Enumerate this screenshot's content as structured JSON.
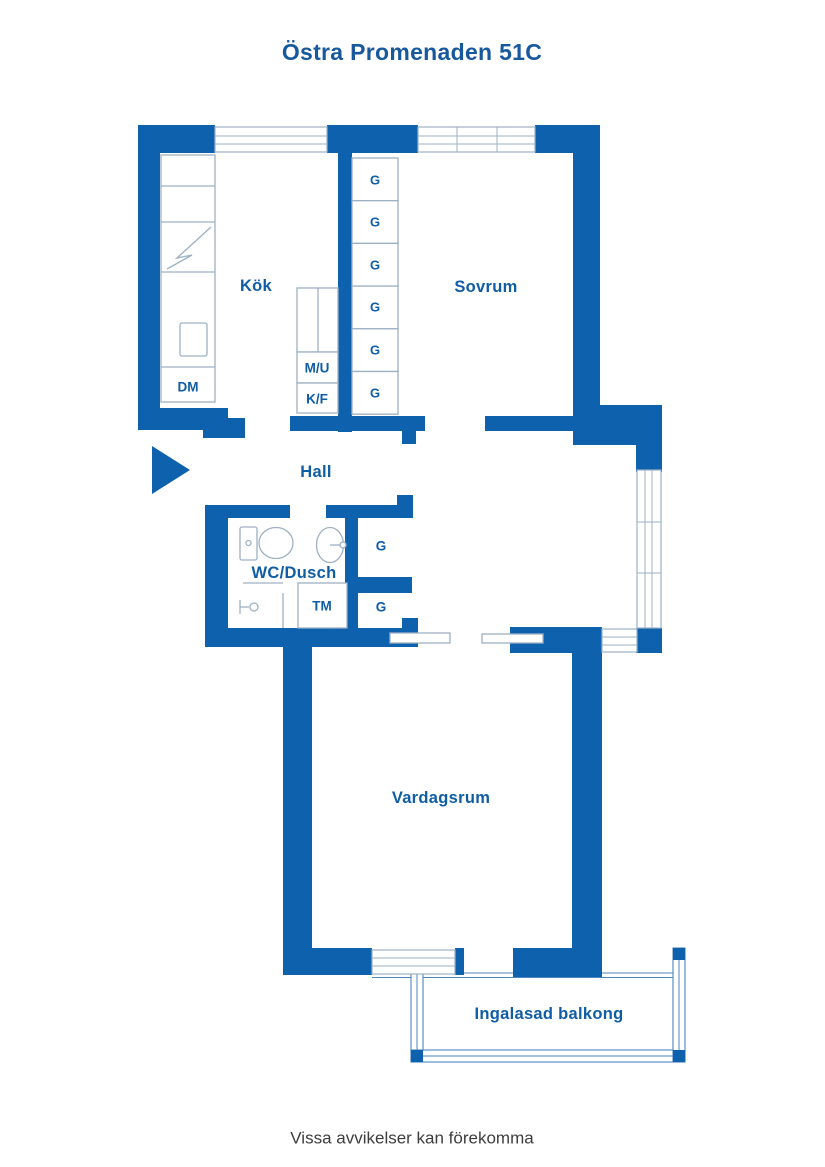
{
  "title": "Östra Promenaden 51C",
  "disclaimer": "Vissa avvikelser kan förekomma",
  "rooms": {
    "kitchen": {
      "label": "Kök"
    },
    "bedroom": {
      "label": "Sovrum"
    },
    "hall": {
      "label": "Hall"
    },
    "bathroom": {
      "label": "WC/Dusch"
    },
    "living_room": {
      "label": "Vardagsrum"
    },
    "balcony": {
      "label": "Ingalasad balkong"
    }
  },
  "fixtures": {
    "dishwasher": "DM",
    "microwave_oven": "M/U",
    "fridge_freezer": "K/F",
    "washing_machine": "TM",
    "wardrobe": "G"
  },
  "colors": {
    "wall": "#0e62ad",
    "label": "#0f5da5",
    "title": "#17599c",
    "fixture_line": "#9db0c4",
    "glazing_line": "#4d85bd",
    "disclaimer_text": "#3d3d3d"
  }
}
